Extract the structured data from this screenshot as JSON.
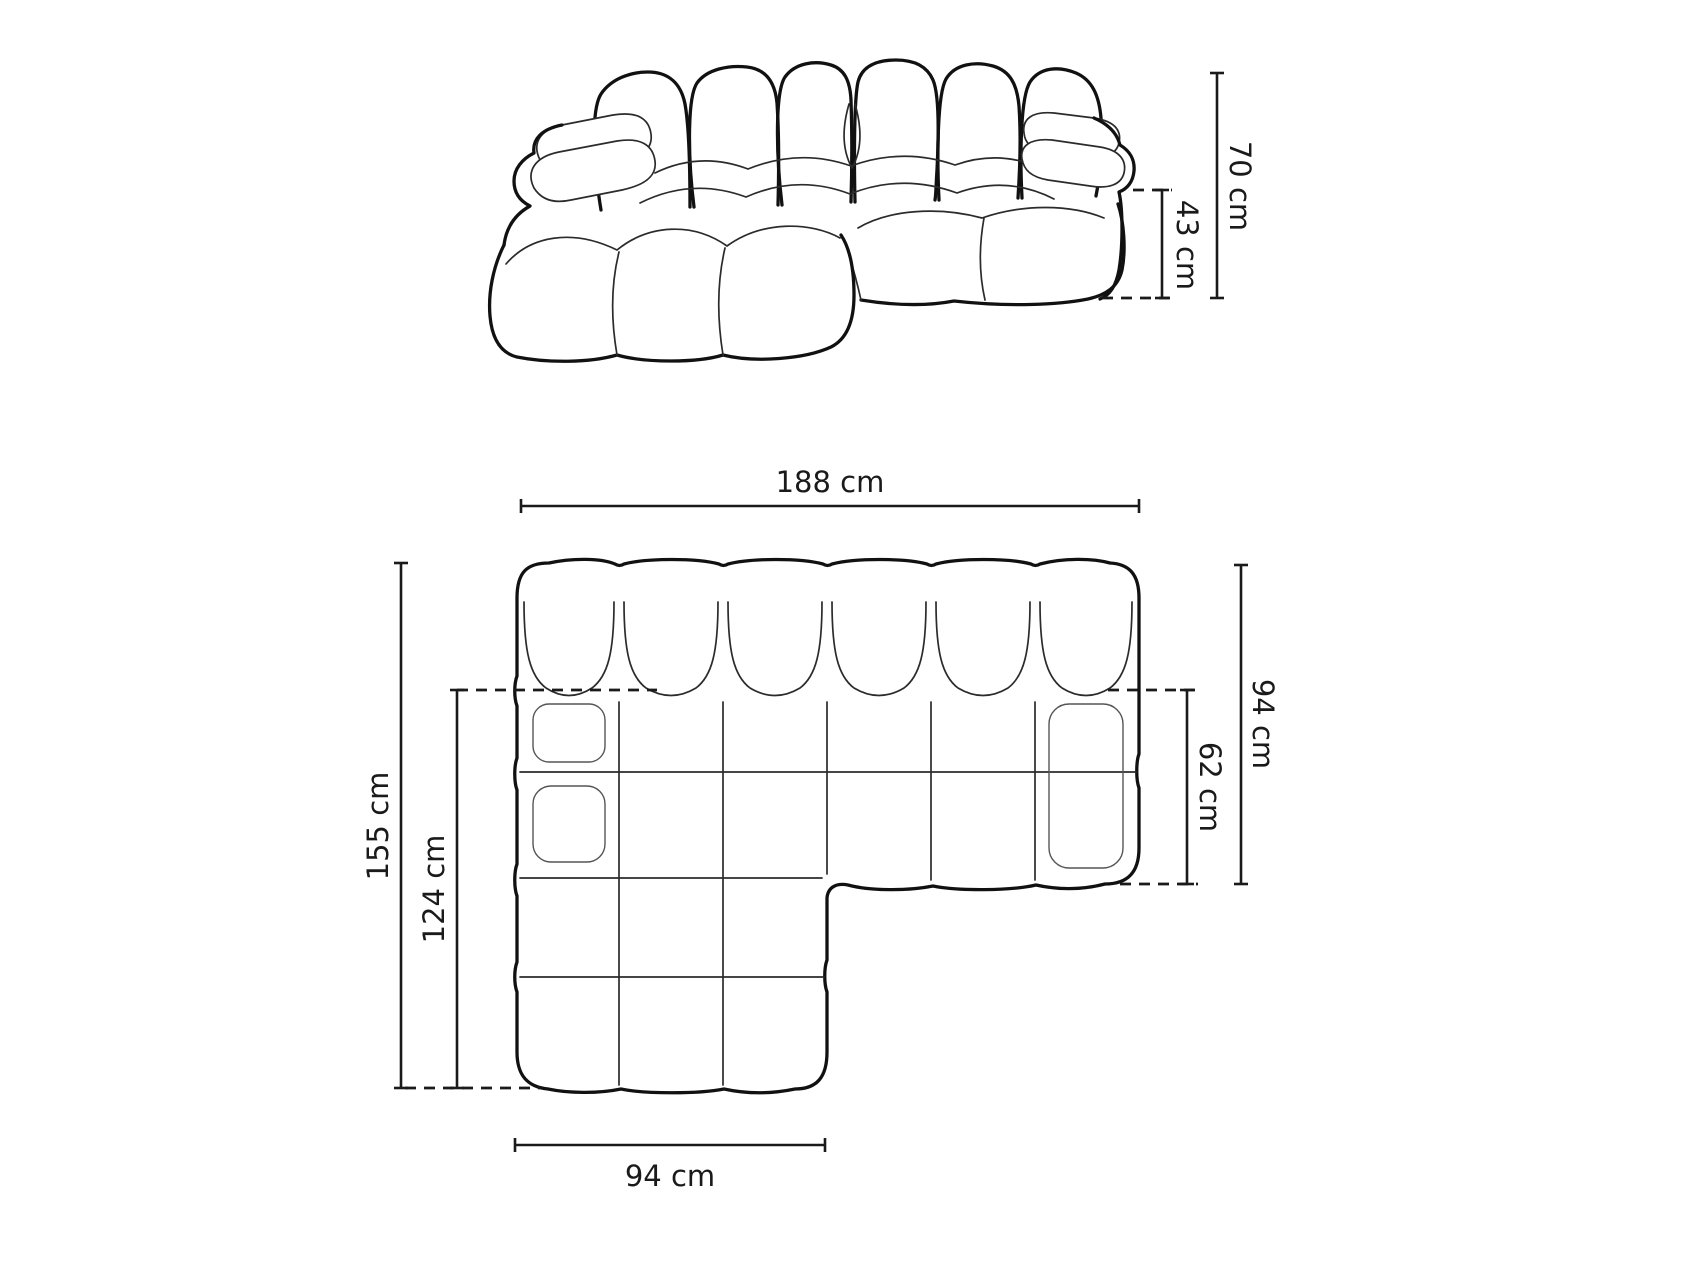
{
  "style": {
    "background": "#ffffff",
    "line_color": "#1a1a1a"
  },
  "front_view": {
    "dims": {
      "total_height": {
        "label": "70 cm"
      },
      "seat_height": {
        "label": "43 cm"
      }
    }
  },
  "plan_view": {
    "dims": {
      "total_width": {
        "label": "188 cm"
      },
      "total_depth": {
        "label": "94 cm"
      },
      "seat_depth": {
        "label": "62 cm"
      },
      "chaise_length": {
        "label": "155 cm"
      },
      "chaise_seat_depth": {
        "label": "124 cm"
      },
      "chaise_width": {
        "label": "94 cm"
      }
    }
  }
}
